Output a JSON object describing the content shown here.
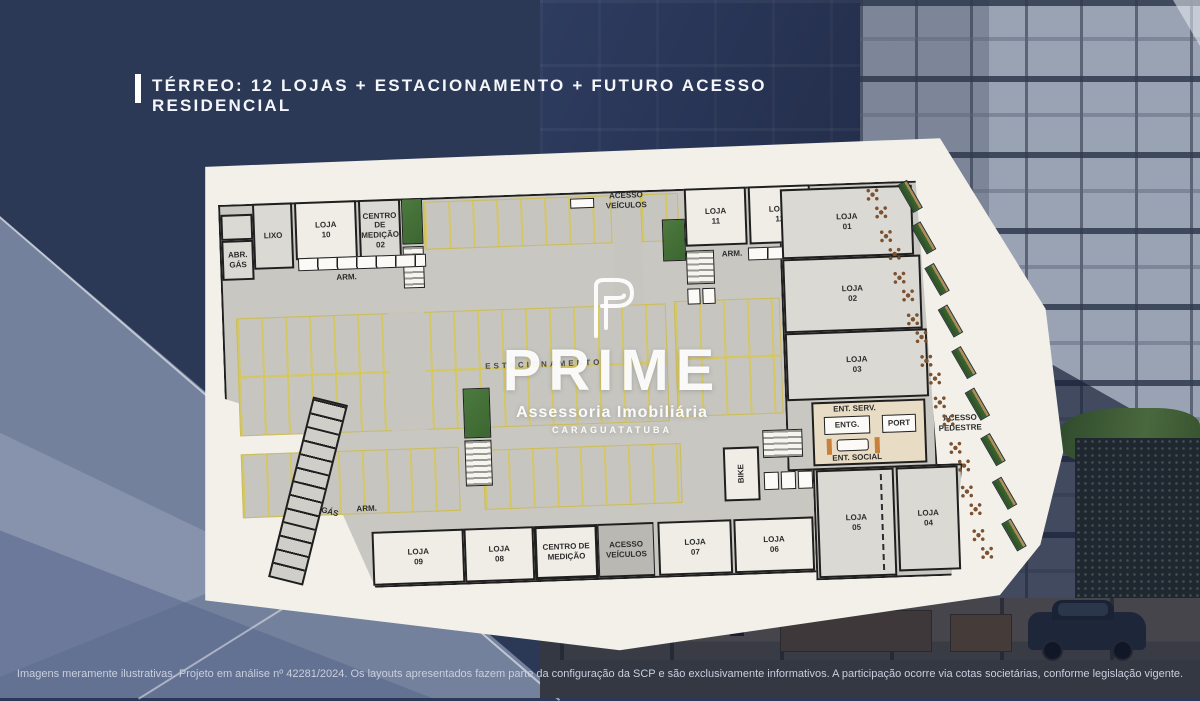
{
  "header": {
    "title": "TÉRREO: 12 LOJAS + ESTACIONAMENTO + FUTURO ACESSO RESIDENCIAL"
  },
  "watermark": {
    "brand": "PRIME",
    "tagline": "Assessoria Imobiliária",
    "city": "CARAGUATATUBA"
  },
  "footer": {
    "disclaimer": "Imagens meramente ilustrativas. Projeto em análise nº 42281/2024. Os layouts apresentados fazem parte da configuração da SCP e são exclusivamente informativos. A participação ocorre via cotas societárias, conforme legislação vigente."
  },
  "plan": {
    "estacionamento": "ESTACIONAMENTO",
    "acesso_veiculos": "ACESSO VEÍCULOS",
    "acesso_pedestre": "ACESSO PEDESTRE",
    "ent_serv": "ENT. SERV.",
    "entg": "ENTG.",
    "port": "PORT",
    "ent_social": "ENT. SOCIAL",
    "bike": "BIKE",
    "gas": "GÁS",
    "abr_gas": "ABR. GÁS",
    "lixo": "LIXO",
    "arm": "ARM.",
    "centro_medicao_02": "CENTRO DE MEDIÇÃO 02",
    "centro_medicao": "CENTRO DE MEDIÇÃO",
    "lojas": [
      {
        "name": "LOJA",
        "num": "10"
      },
      {
        "name": "LOJA",
        "num": "11"
      },
      {
        "name": "LOJA",
        "num": "12"
      },
      {
        "name": "LOJA",
        "num": "01"
      },
      {
        "name": "LOJA",
        "num": "02"
      },
      {
        "name": "LOJA",
        "num": "03"
      },
      {
        "name": "LOJA",
        "num": "04"
      },
      {
        "name": "LOJA",
        "num": "05"
      },
      {
        "name": "LOJA",
        "num": "06"
      },
      {
        "name": "LOJA",
        "num": "07"
      },
      {
        "name": "LOJA",
        "num": "08"
      },
      {
        "name": "LOJA",
        "num": "09"
      }
    ]
  },
  "colors": {
    "background_navy": "#2b3956",
    "paper": "#f2f0e9",
    "plan_floor": "#c8c7c1",
    "parking_stripe_yellow": "#d6c75f",
    "landscape_green": "#4c7a3f",
    "lobby_tan": "#e9dcc4",
    "wall_black": "#1f1f1f",
    "text_white": "#f4f6fb"
  }
}
